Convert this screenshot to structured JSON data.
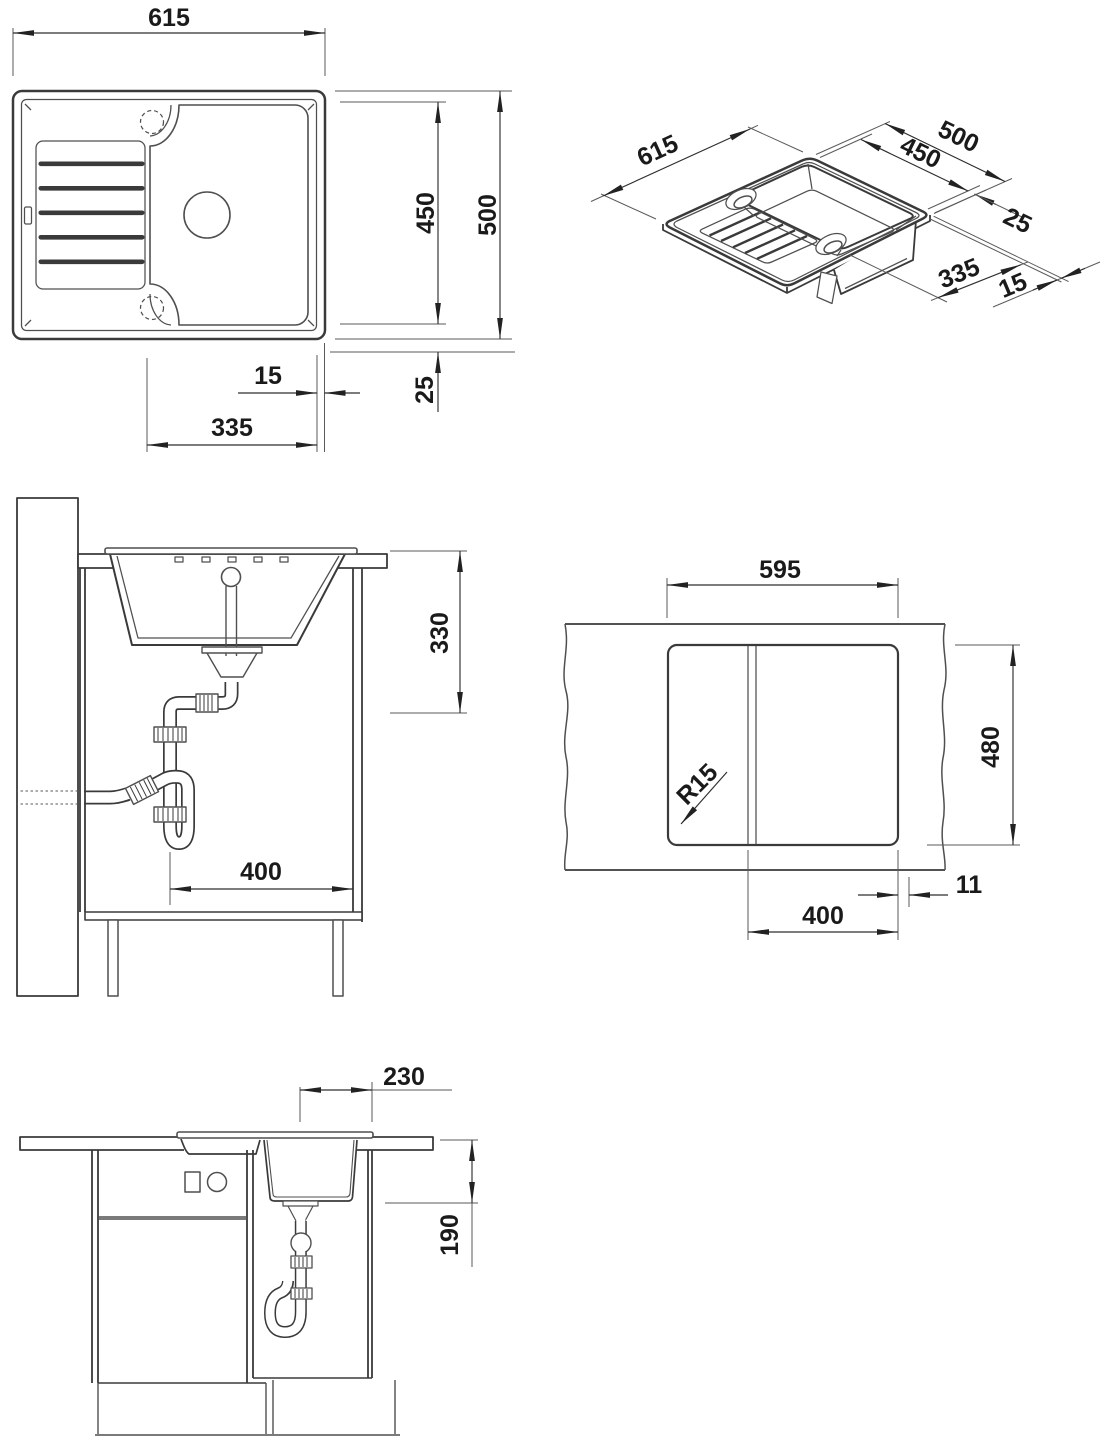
{
  "document": {
    "type": "technical-installation-drawing",
    "subject": "inset kitchen sink with drainboard, plumbing and worktop cut-out",
    "background_color": "#ffffff",
    "line_color": "#3a3a3a",
    "dim_text_color": "#1a1a1a"
  },
  "views": {
    "top": {
      "label": "top view",
      "dim_width": "615",
      "dim_depth_inner": "450",
      "dim_depth_overall": "500",
      "dim_rim_right": "15",
      "dim_bowl_width": "335",
      "dim_edge_offset": "25"
    },
    "iso": {
      "label": "isometric view",
      "dim_width": "615",
      "dim_depth_overall": "500",
      "dim_depth_inner": "450",
      "dim_edge_offset": "25",
      "dim_bowl_width": "335",
      "dim_rim_right": "15"
    },
    "side": {
      "label": "side section with trap",
      "dim_clearance_depth": "330",
      "dim_drain_offset": "400"
    },
    "cutout": {
      "label": "worktop cut-out plan",
      "dim_cutout_width": "595",
      "dim_cutout_depth": "480",
      "dim_corner_radius": "R15",
      "dim_edge_gap": "11",
      "dim_drain_line": "400"
    },
    "front": {
      "label": "front section with trap",
      "dim_bowl_offset": "230",
      "dim_bowl_depth": "190"
    }
  }
}
